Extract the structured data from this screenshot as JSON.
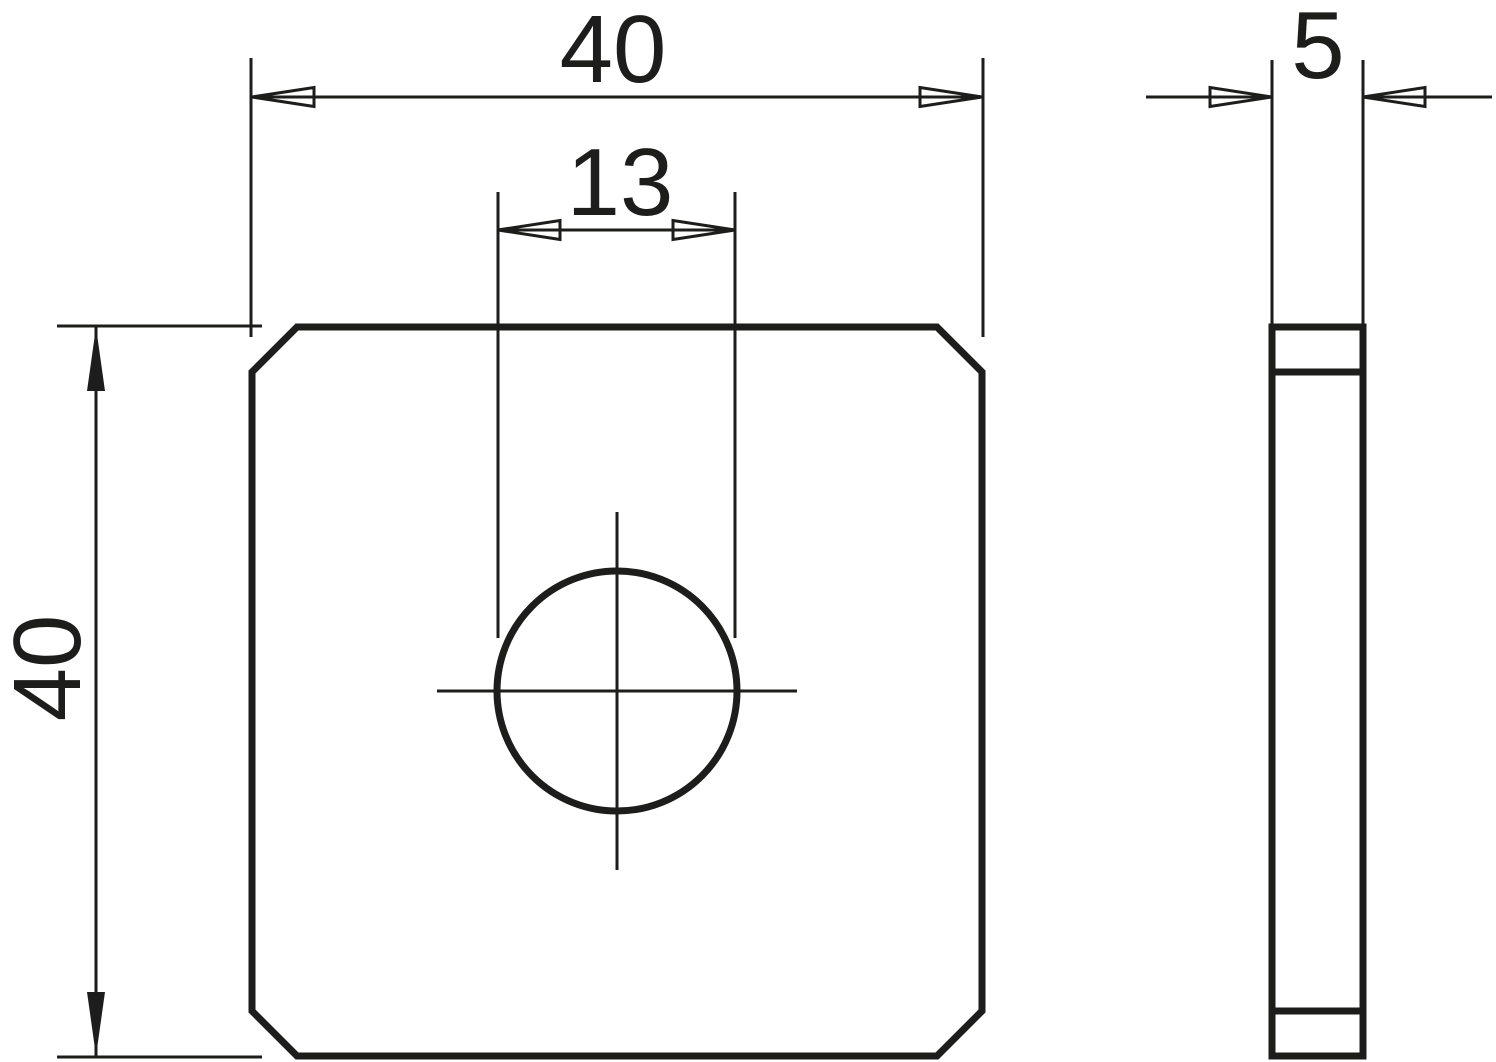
{
  "canvas": {
    "background_color": "#ffffff",
    "line_color": "#1d1d1b"
  },
  "front_view": {
    "width_dimension_label": "40",
    "height_dimension_label": "40",
    "hole_diameter_dimension_label": "13"
  },
  "side_view": {
    "thickness_dimension_label": "5"
  }
}
